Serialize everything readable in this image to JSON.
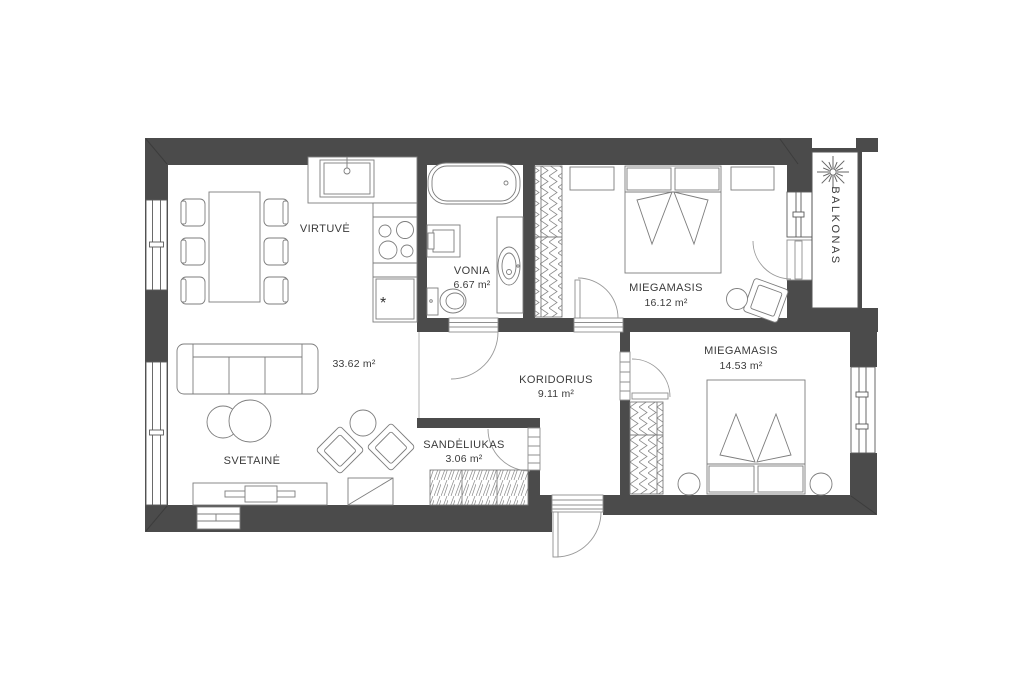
{
  "plan": {
    "title": "apartment-floor-plan",
    "colors": {
      "wall": "#4b4b4b",
      "furniture_line": "#8a8a8a",
      "text": "#3b3b3b",
      "background": "#ffffff"
    },
    "symbols": {
      "fridge": "*"
    },
    "rooms": {
      "kitchen": {
        "name": "VIRTUVĖ",
        "area": ""
      },
      "bathroom": {
        "name": "VONIA",
        "area": "6.67 m²"
      },
      "bedroom1": {
        "name": "MIEGAMASIS",
        "area": "16.12 m²"
      },
      "balcony": {
        "name": "BALKONAS",
        "area": ""
      },
      "living": {
        "name": "SVETAINĖ",
        "area": "33.62 m²"
      },
      "corridor": {
        "name": "KORIDORIUS",
        "area": "9.11 m²"
      },
      "storage": {
        "name": "SANDĖLIUKAS",
        "area": "3.06 m²"
      },
      "bedroom2": {
        "name": "MIEGAMASIS",
        "area": "14.53 m²"
      }
    }
  }
}
